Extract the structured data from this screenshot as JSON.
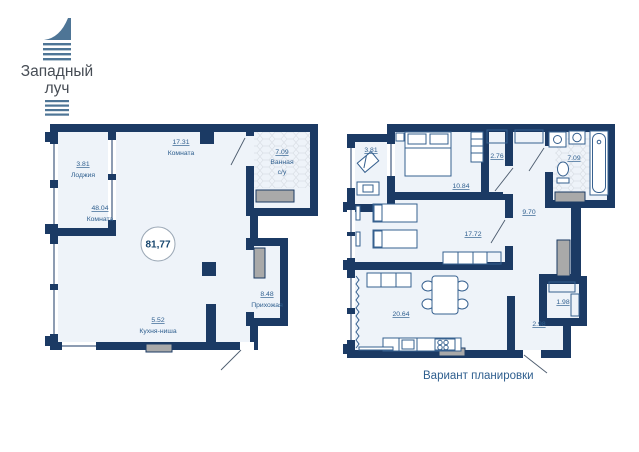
{
  "brand": {
    "line1": "Западный",
    "line2": "луч"
  },
  "colors": {
    "wall": "#1b3a64",
    "floor": "#eef3f9",
    "label": "#2e5e8e",
    "shaft": "#a9a9a9",
    "logo": "#4e7596",
    "logo_text": "#474d55"
  },
  "plan_main": {
    "total_area": "81,77",
    "rooms": {
      "loggia": {
        "area": "3.81",
        "label": "Лоджия"
      },
      "room1": {
        "area": "17.31",
        "label": "Комната"
      },
      "bath": {
        "area": "7.09",
        "label1": "Ванная",
        "label2": "с/у"
      },
      "room2": {
        "area": "48.04",
        "label": "Комната"
      },
      "hallway": {
        "area": "8.48",
        "label": "Прихожая"
      },
      "kitchen": {
        "area": "5.52",
        "label": "Кухня-ниша"
      }
    }
  },
  "plan_variant": {
    "caption": "Вариант планировки",
    "areas": {
      "loggia": "3.81",
      "bedroom": "10.84",
      "closet": "2.76",
      "bath": "7.09",
      "corridor": "9.70",
      "room": "17.72",
      "storage": "1.98",
      "living": "20.64",
      "hall": "2.98"
    }
  }
}
